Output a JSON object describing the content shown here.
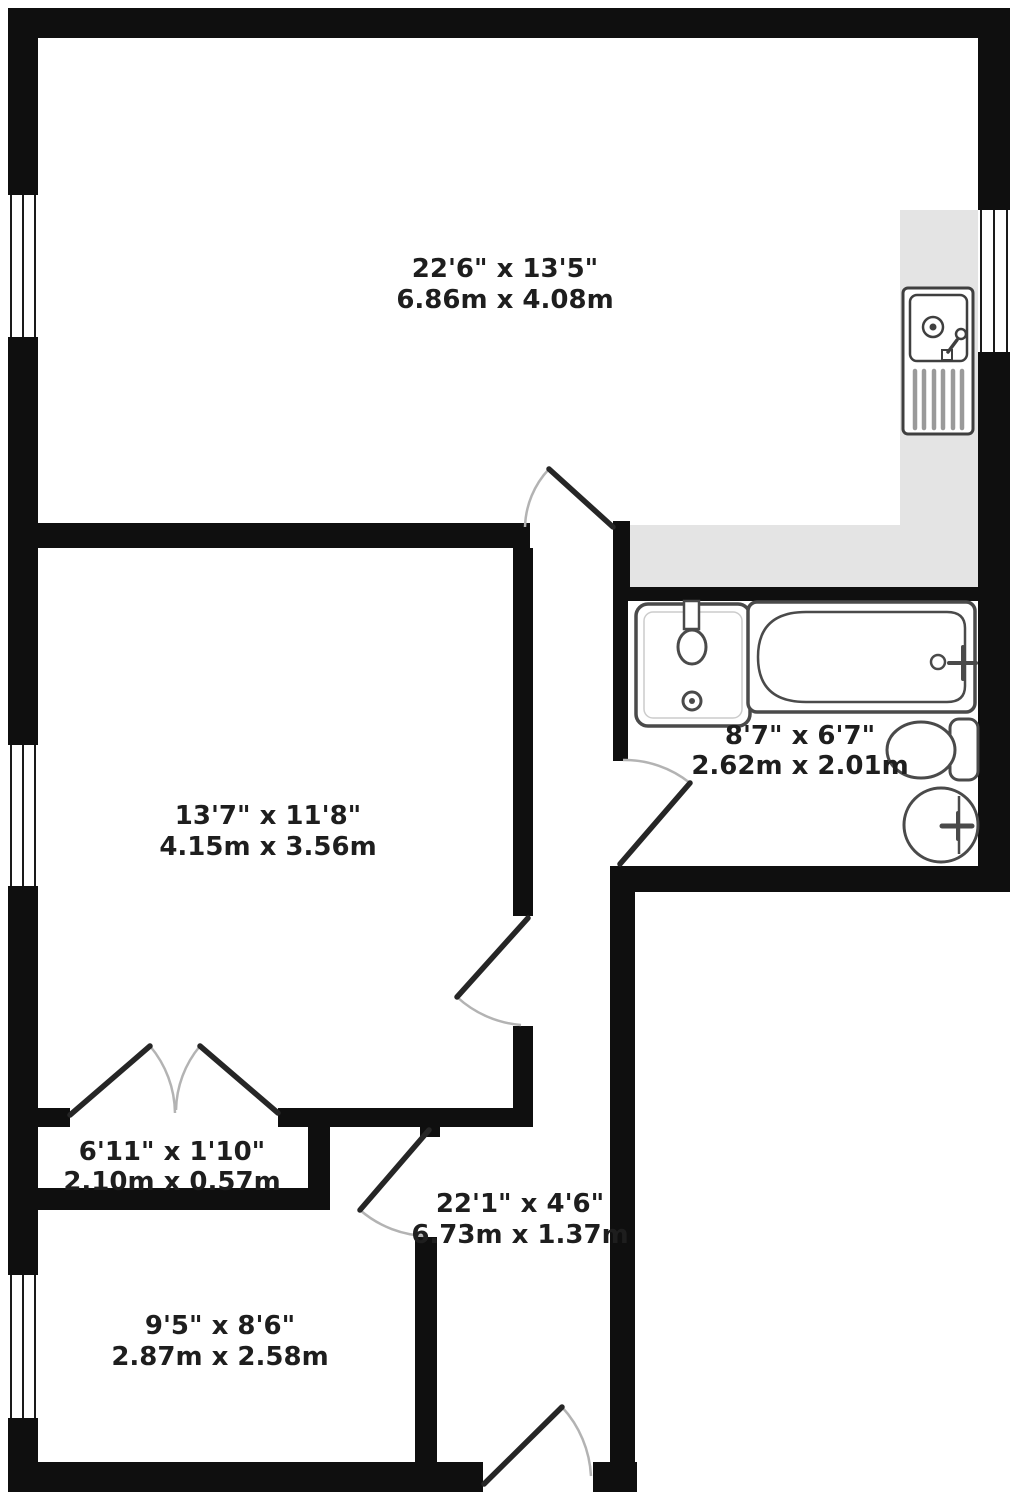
{
  "floorplan": {
    "colors": {
      "background": "#ffffff",
      "wall": "#0f0f0f",
      "counter": "#e4e4e4",
      "fixture_outline": "#4a4a4a",
      "door_leaf": "#262626",
      "door_arc": "#b3b3b3",
      "label": "#1e1e1e"
    },
    "rooms": [
      {
        "id": "reception-kitchen",
        "imperial": "22'6\" x 13'5\"",
        "metric": "6.86m x 4.08m"
      },
      {
        "id": "bathroom",
        "imperial": "8'7\" x 6'7\"",
        "metric": "2.62m x 2.01m"
      },
      {
        "id": "bedroom-1",
        "imperial": "13'7\" x 11'8\"",
        "metric": "4.15m x 3.56m"
      },
      {
        "id": "closet",
        "imperial": "6'11\" x 1'10\"",
        "metric": "2.10m x 0.57m"
      },
      {
        "id": "hallway",
        "imperial": "22'1\" x 4'6\"",
        "metric": "6.73m x 1.37m"
      },
      {
        "id": "bedroom-2",
        "imperial": "9'5\" x 8'6\"",
        "metric": "2.87m x 2.58m"
      }
    ],
    "fixtures": [
      "kitchen-sink",
      "bathroom-sink",
      "bathtub",
      "toilet",
      "wash-basin"
    ]
  }
}
